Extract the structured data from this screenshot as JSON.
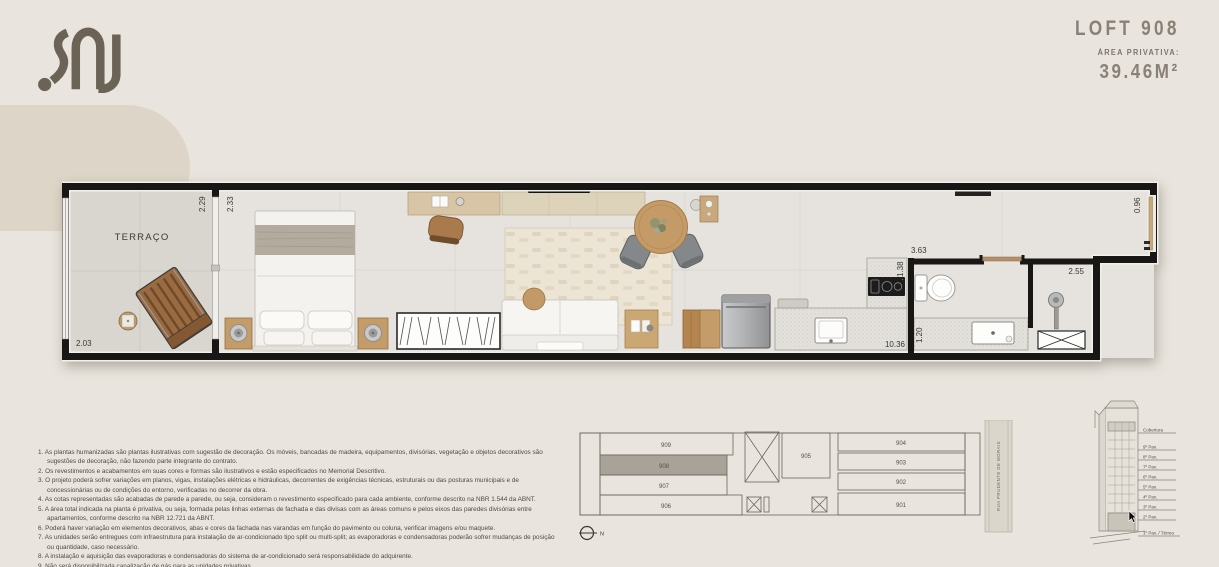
{
  "brand": {
    "logo_icon": "sal-logo"
  },
  "header": {
    "title": "LOFT 908",
    "area_label": "ÁREA PRIVATIVA:",
    "area_value": "39.46M²"
  },
  "floor_plan": {
    "room_label": "TERRAÇO",
    "dims": {
      "terrace_width": "2.03",
      "terrace_door": "2.29",
      "bedroom_door": "2.33",
      "kitchen_width": "3.63",
      "counter_depth": "1.38",
      "unit_length": "10.36",
      "bath_width": "1.20",
      "bath_length": "2.55",
      "hall_width": "0.96"
    }
  },
  "key_plan": {
    "units": [
      "909",
      "908",
      "907",
      "906",
      "905",
      "904",
      "903",
      "902",
      "901"
    ],
    "highlighted_unit": "908",
    "street_label": "RUA PRUDENTE DE MORAIS",
    "north_label": "N"
  },
  "elevation": {
    "floors": [
      "Cobertura",
      "9º Pav.",
      "8º Pav.",
      "7º Pav.",
      "6º Pav.",
      "5º Pav.",
      "4º Pav.",
      "3º Pav.",
      "2º Pav.",
      "1º Pav. / Térreo"
    ]
  },
  "notes": [
    "1. As plantas humanizadas são plantas ilustrativas com sugestão de decoração. Os móveis, bancadas de madeira, equipamentos, divisórias, vegetação e objetos decorativos são sugestões de decoração, não fazendo parte integrante do contrato.",
    "2. Os revestimentos e acabamentos em suas cores e formas são ilustrativos e estão especificados no Memorial Descritivo.",
    "3. O projeto poderá sofrer variações em planos, vigas, instalações elétricas e hidráulicas, decorrentes de exigências técnicas, estruturais ou das posturas municipais e de concessionárias ou de condições do entorno, verificadas no decorrer da obra.",
    "4. As cotas representadas são acabadas de parede a parede, ou seja, consideram o revestimento especificado para cada ambiente, conforme descrito na NBR 1.544 da ABNT.",
    "5. A área total indicada na planta é privativa, ou seja, formada pelas linhas externas de fachada e das divisas com as áreas comuns e pelos eixos das paredes divisórias entre apartamentos, conforme descrito na NBR 12.721 da ABNT.",
    "6. Poderá haver variação em elementos decorativos, abas e cores da fachada nas varandas em função do pavimento ou coluna, verificar imagens e/ou maquete.",
    "7. As unidades serão entregues com infraestrutura para instalação de ar-condicionado tipo split ou multi-split; as evaporadoras e condensadoras poderão sofrer mudanças de posição ou quantidade, caso necessário.",
    "8. A instalação e aquisição das evaporadoras e condensadoras do sistema de ar-condicionado será responsabilidade do adquirente.",
    "9. Não será disponibilizada canalização de gás para as unidades privativas.",
    "10. No projeto das unidades está prevista a utilização de cooktop elétrico, atendendo às exigências dos órgãos públicos."
  ],
  "colors": {
    "accent_taupe": "#8a8076",
    "logo_brown": "#6b6356",
    "highlight_gray": "#a8a298",
    "wall": "#181715"
  }
}
